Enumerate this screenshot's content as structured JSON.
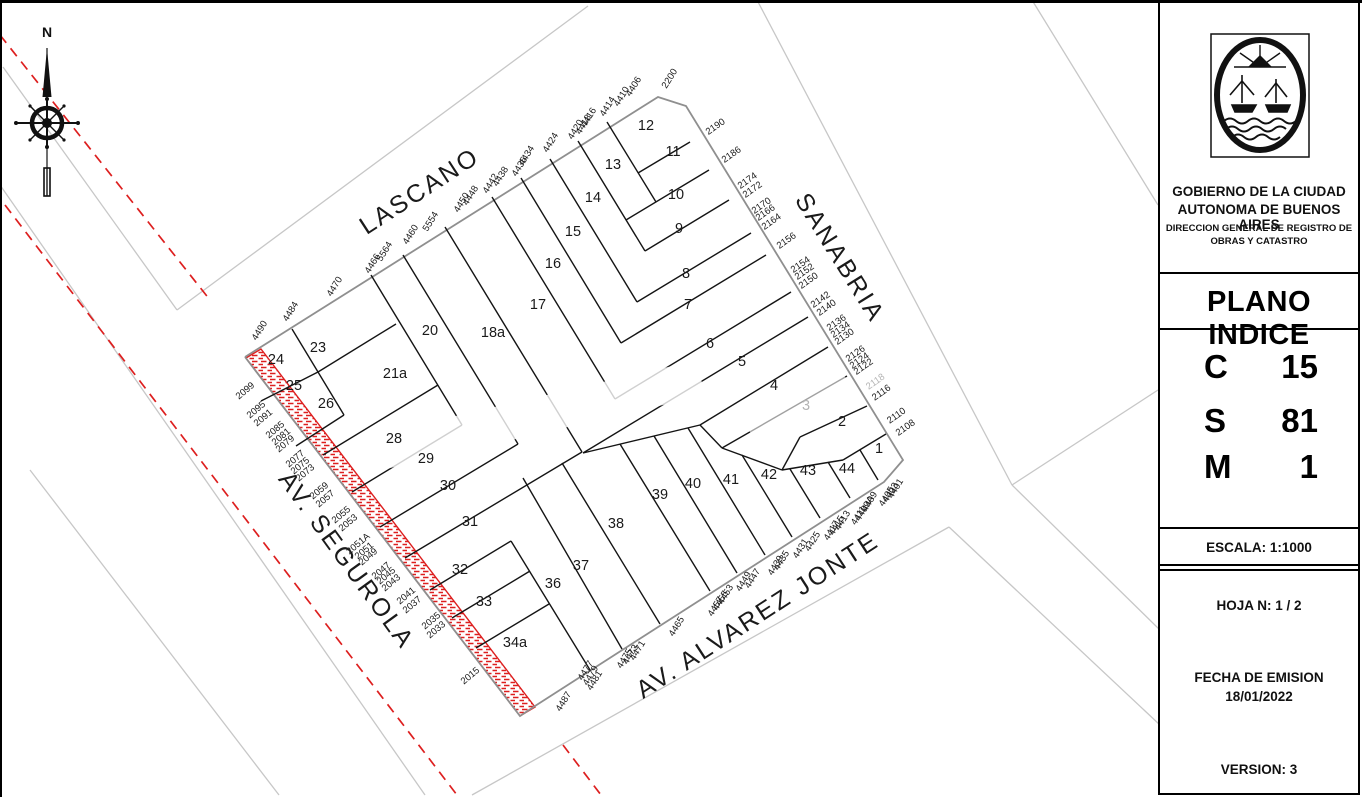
{
  "panel": {
    "org_line1": "GOBIERNO DE LA CIUDAD",
    "org_line2": "AUTONOMA DE BUENOS AIRES",
    "org_line3": "DIRECCION GENERAL DE REGISTRO DE",
    "org_line4": "OBRAS Y CATASTRO",
    "doc_title": "PLANO INDICE",
    "codes": [
      {
        "key": "C",
        "value": "15"
      },
      {
        "key": "S",
        "value": "81"
      },
      {
        "key": "M",
        "value": "1"
      }
    ],
    "escala": "ESCALA:   1:1000",
    "hoja": "HOJA N:   1 / 2",
    "fecha_label": "FECHA DE EMISION",
    "fecha_value": "18/01/2022",
    "version": "VERSION: 3"
  },
  "map": {
    "compass_label": "N",
    "colors": {
      "lot_line": "#141414",
      "outline": "#8f8f8f",
      "context": "#c7c7c7",
      "red": "#dd1f1f",
      "label": "#1a1a1a",
      "faded": "#b4b4b4"
    },
    "streets": [
      {
        "name": "LASCANO",
        "x": 424,
        "y": 198,
        "rot": -33
      },
      {
        "name": "SANABRIA",
        "x": 833,
        "y": 262,
        "rot": 58
      },
      {
        "name": "AV. SEGUROLA",
        "x": 340,
        "y": 565,
        "rot": 54
      },
      {
        "name": "AV. ALVAREZ JONTE",
        "x": 762,
        "y": 622,
        "rot": -33
      }
    ],
    "parcels": [
      {
        "n": "1",
        "x": 879,
        "y": 453
      },
      {
        "n": "2",
        "x": 842,
        "y": 426
      },
      {
        "n": "3",
        "x": 806,
        "y": 410,
        "faded": true
      },
      {
        "n": "4",
        "x": 774,
        "y": 390
      },
      {
        "n": "5",
        "x": 742,
        "y": 366
      },
      {
        "n": "6",
        "x": 710,
        "y": 348
      },
      {
        "n": "7",
        "x": 688,
        "y": 309
      },
      {
        "n": "8",
        "x": 686,
        "y": 278
      },
      {
        "n": "9",
        "x": 679,
        "y": 233
      },
      {
        "n": "10",
        "x": 676,
        "y": 199
      },
      {
        "n": "11",
        "x": 673,
        "y": 156
      },
      {
        "n": "12",
        "x": 646,
        "y": 130
      },
      {
        "n": "13",
        "x": 613,
        "y": 169
      },
      {
        "n": "14",
        "x": 593,
        "y": 202
      },
      {
        "n": "15",
        "x": 573,
        "y": 236
      },
      {
        "n": "16",
        "x": 553,
        "y": 268
      },
      {
        "n": "17",
        "x": 538,
        "y": 309
      },
      {
        "n": "18a",
        "x": 493,
        "y": 337
      },
      {
        "n": "20",
        "x": 430,
        "y": 335
      },
      {
        "n": "21a",
        "x": 395,
        "y": 378
      },
      {
        "n": "23",
        "x": 318,
        "y": 352
      },
      {
        "n": "24",
        "x": 276,
        "y": 364
      },
      {
        "n": "25",
        "x": 294,
        "y": 390
      },
      {
        "n": "26",
        "x": 326,
        "y": 408
      },
      {
        "n": "28",
        "x": 394,
        "y": 443
      },
      {
        "n": "29",
        "x": 426,
        "y": 463
      },
      {
        "n": "30",
        "x": 448,
        "y": 490
      },
      {
        "n": "31",
        "x": 470,
        "y": 526
      },
      {
        "n": "32",
        "x": 460,
        "y": 574
      },
      {
        "n": "33",
        "x": 484,
        "y": 606
      },
      {
        "n": "34a",
        "x": 515,
        "y": 647
      },
      {
        "n": "36",
        "x": 553,
        "y": 588
      },
      {
        "n": "37",
        "x": 581,
        "y": 570
      },
      {
        "n": "38",
        "x": 616,
        "y": 528
      },
      {
        "n": "39",
        "x": 660,
        "y": 499
      },
      {
        "n": "40",
        "x": 693,
        "y": 488
      },
      {
        "n": "41",
        "x": 731,
        "y": 484
      },
      {
        "n": "42",
        "x": 769,
        "y": 479
      },
      {
        "n": "43",
        "x": 808,
        "y": 475
      },
      {
        "n": "44",
        "x": 847,
        "y": 473
      }
    ],
    "addresses": {
      "lascano": {
        "rot": -58,
        "items": [
          {
            "t": "4490",
            "x": 262,
            "y": 332
          },
          {
            "t": "4484",
            "x": 293,
            "y": 313
          },
          {
            "t": "4470",
            "x": 337,
            "y": 288
          },
          {
            "t": "4466",
            "x": 375,
            "y": 265
          },
          {
            "t": "5564",
            "x": 387,
            "y": 253
          },
          {
            "t": "4460",
            "x": 413,
            "y": 236
          },
          {
            "t": "5554",
            "x": 433,
            "y": 223
          },
          {
            "t": "4450",
            "x": 464,
            "y": 204
          },
          {
            "t": "4448",
            "x": 473,
            "y": 197
          },
          {
            "t": "4442",
            "x": 493,
            "y": 185
          },
          {
            "t": "4438",
            "x": 503,
            "y": 178
          },
          {
            "t": "4436",
            "x": 522,
            "y": 168
          },
          {
            "t": "4434",
            "x": 529,
            "y": 157
          },
          {
            "t": "4424",
            "x": 553,
            "y": 144
          },
          {
            "t": "4420",
            "x": 578,
            "y": 131
          },
          {
            "t": "4418",
            "x": 586,
            "y": 126
          },
          {
            "t": "4416",
            "x": 591,
            "y": 119
          },
          {
            "t": "4414",
            "x": 610,
            "y": 108
          },
          {
            "t": "4410",
            "x": 624,
            "y": 98
          },
          {
            "t": "4406",
            "x": 636,
            "y": 88
          },
          {
            "t": "2200",
            "x": 672,
            "y": 80
          }
        ]
      },
      "sanabria": {
        "rot": -35,
        "items": [
          {
            "t": "2190",
            "x": 717,
            "y": 129
          },
          {
            "t": "2186",
            "x": 733,
            "y": 157
          },
          {
            "t": "2174",
            "x": 749,
            "y": 183
          },
          {
            "t": "2172",
            "x": 754,
            "y": 192
          },
          {
            "t": "2170",
            "x": 763,
            "y": 208
          },
          {
            "t": "2166",
            "x": 767,
            "y": 215
          },
          {
            "t": "2164",
            "x": 773,
            "y": 224
          },
          {
            "t": "2156",
            "x": 788,
            "y": 243
          },
          {
            "t": "2154",
            "x": 802,
            "y": 267
          },
          {
            "t": "2152",
            "x": 806,
            "y": 274
          },
          {
            "t": "2150",
            "x": 810,
            "y": 283
          },
          {
            "t": "2142",
            "x": 822,
            "y": 302
          },
          {
            "t": "2140",
            "x": 828,
            "y": 310
          },
          {
            "t": "2136",
            "x": 838,
            "y": 325
          },
          {
            "t": "2134",
            "x": 842,
            "y": 332
          },
          {
            "t": "2130",
            "x": 846,
            "y": 339
          },
          {
            "t": "2126",
            "x": 857,
            "y": 356
          },
          {
            "t": "2124",
            "x": 861,
            "y": 363
          },
          {
            "t": "2122",
            "x": 865,
            "y": 369
          },
          {
            "t": "2118",
            "x": 877,
            "y": 384,
            "faded": true
          },
          {
            "t": "2116",
            "x": 883,
            "y": 395
          },
          {
            "t": "2110",
            "x": 898,
            "y": 418
          },
          {
            "t": "2108",
            "x": 907,
            "y": 430
          }
        ]
      },
      "segurola": {
        "rot": -40,
        "items": [
          {
            "t": "2099",
            "x": 247,
            "y": 393
          },
          {
            "t": "2095",
            "x": 258,
            "y": 412
          },
          {
            "t": "2091",
            "x": 265,
            "y": 420
          },
          {
            "t": "2085",
            "x": 277,
            "y": 432
          },
          {
            "t": "2081",
            "x": 283,
            "y": 439
          },
          {
            "t": "2079",
            "x": 287,
            "y": 446
          },
          {
            "t": "2077",
            "x": 297,
            "y": 461
          },
          {
            "t": "2075",
            "x": 302,
            "y": 468
          },
          {
            "t": "2073",
            "x": 307,
            "y": 475
          },
          {
            "t": "2059",
            "x": 321,
            "y": 493
          },
          {
            "t": "2057",
            "x": 327,
            "y": 501
          },
          {
            "t": "2055",
            "x": 343,
            "y": 517
          },
          {
            "t": "2053",
            "x": 350,
            "y": 525
          },
          {
            "t": "2051A",
            "x": 360,
            "y": 546
          },
          {
            "t": "2051",
            "x": 366,
            "y": 553
          },
          {
            "t": "2049",
            "x": 370,
            "y": 559
          },
          {
            "t": "2047",
            "x": 383,
            "y": 573
          },
          {
            "t": "2045",
            "x": 388,
            "y": 578
          },
          {
            "t": "2043",
            "x": 393,
            "y": 585
          },
          {
            "t": "2041",
            "x": 408,
            "y": 598
          },
          {
            "t": "2037",
            "x": 414,
            "y": 607
          },
          {
            "t": "2035",
            "x": 433,
            "y": 623
          },
          {
            "t": "2033",
            "x": 438,
            "y": 632
          },
          {
            "t": "2015",
            "x": 472,
            "y": 678
          }
        ]
      },
      "jonte": {
        "rot": -58,
        "items": [
          {
            "t": "4487",
            "x": 566,
            "y": 703
          },
          {
            "t": "4481",
            "x": 597,
            "y": 682
          },
          {
            "t": "4479",
            "x": 593,
            "y": 677
          },
          {
            "t": "4477",
            "x": 588,
            "y": 672
          },
          {
            "t": "4475",
            "x": 627,
            "y": 660
          },
          {
            "t": "4473",
            "x": 633,
            "y": 656
          },
          {
            "t": "4471",
            "x": 640,
            "y": 652
          },
          {
            "t": "4465",
            "x": 679,
            "y": 628
          },
          {
            "t": "4457",
            "x": 718,
            "y": 608
          },
          {
            "t": "4455",
            "x": 723,
            "y": 602
          },
          {
            "t": "4453",
            "x": 728,
            "y": 596
          },
          {
            "t": "4449",
            "x": 746,
            "y": 583
          },
          {
            "t": "4447",
            "x": 755,
            "y": 580
          },
          {
            "t": "4439",
            "x": 778,
            "y": 567
          },
          {
            "t": "4435",
            "x": 784,
            "y": 562
          },
          {
            "t": "4431",
            "x": 803,
            "y": 550
          },
          {
            "t": "4425",
            "x": 815,
            "y": 543
          },
          {
            "t": "4417",
            "x": 834,
            "y": 532
          },
          {
            "t": "4415",
            "x": 839,
            "y": 527
          },
          {
            "t": "4413",
            "x": 845,
            "y": 522
          },
          {
            "t": "4411",
            "x": 861,
            "y": 517
          },
          {
            "t": "4409A",
            "x": 867,
            "y": 510
          },
          {
            "t": "4409",
            "x": 872,
            "y": 503
          },
          {
            "t": "4405",
            "x": 889,
            "y": 498
          },
          {
            "t": "4403",
            "x": 893,
            "y": 494
          },
          {
            "t": "4401",
            "x": 898,
            "y": 490
          }
        ]
      }
    },
    "outline": [
      [
        245,
        357
      ],
      [
        658,
        97
      ],
      [
        686,
        106
      ],
      [
        903,
        460
      ],
      [
        884,
        482
      ],
      [
        535,
        706
      ],
      [
        520,
        716
      ],
      [
        245,
        357
      ]
    ],
    "hatch_strip": [
      [
        246,
        358
      ],
      [
        520,
        716
      ],
      [
        535,
        707
      ],
      [
        261,
        349
      ]
    ],
    "lot_lines": [
      [
        292,
        329,
        318,
        372
      ],
      [
        261,
        401,
        318,
        372
      ],
      [
        318,
        372,
        396,
        324
      ],
      [
        296,
        446,
        344,
        415
      ],
      [
        318,
        372,
        344,
        415
      ],
      [
        371,
        275,
        462,
        425
      ],
      [
        403,
        255,
        518,
        444
      ],
      [
        445,
        227,
        582,
        452
      ],
      [
        492,
        197,
        615,
        399
      ],
      [
        521,
        178,
        621,
        343
      ],
      [
        550,
        159,
        637,
        302
      ],
      [
        578,
        141,
        645,
        251
      ],
      [
        607,
        122,
        656,
        202
      ],
      [
        690,
        142,
        638,
        173
      ],
      [
        709,
        170,
        626,
        220
      ],
      [
        729,
        200,
        645,
        251
      ],
      [
        751,
        233,
        637,
        302
      ],
      [
        766,
        255,
        621,
        343
      ],
      [
        791,
        292,
        615,
        399
      ],
      [
        808,
        317,
        583,
        453
      ],
      [
        828,
        347,
        700,
        425
      ],
      [
        847,
        376,
        722,
        448
      ],
      [
        867,
        406,
        800,
        437
      ],
      [
        886,
        434,
        843,
        460
      ],
      [
        583,
        453,
        700,
        425
      ],
      [
        700,
        425,
        722,
        448
      ],
      [
        722,
        448,
        782,
        470
      ],
      [
        782,
        470,
        843,
        460
      ],
      [
        800,
        437,
        782,
        470
      ],
      [
        323,
        455,
        438,
        385
      ],
      [
        352,
        492,
        462,
        425
      ],
      [
        380,
        527,
        518,
        444
      ],
      [
        405,
        558,
        582,
        452
      ],
      [
        430,
        590,
        511,
        541
      ],
      [
        452,
        618,
        530,
        571
      ],
      [
        476,
        648,
        549,
        604
      ],
      [
        590,
        670,
        511,
        541
      ],
      [
        622,
        649,
        523,
        478
      ],
      [
        660,
        624,
        562,
        463
      ],
      [
        710,
        591,
        620,
        444
      ],
      [
        737,
        573,
        654,
        436
      ],
      [
        765,
        555,
        688,
        428
      ],
      [
        792,
        537,
        742,
        455
      ],
      [
        820,
        518,
        790,
        469
      ],
      [
        850,
        498,
        828,
        462
      ],
      [
        878,
        480,
        860,
        450
      ]
    ],
    "context_lines": [
      [
        3,
        67,
        177,
        310
      ],
      [
        177,
        310,
        588,
        6
      ],
      [
        0,
        185,
        425,
        795
      ],
      [
        30,
        470,
        279,
        795
      ],
      [
        472,
        795,
        949,
        527
      ],
      [
        949,
        527,
        1160,
        725
      ],
      [
        1012,
        485,
        1158,
        390
      ],
      [
        1012,
        485,
        1160,
        630
      ],
      [
        757,
        0,
        1012,
        485
      ],
      [
        1032,
        0,
        1158,
        205
      ]
    ],
    "red_dashed": [
      [
        0,
        35,
        210,
        300
      ],
      [
        5,
        205,
        457,
        795
      ],
      [
        563,
        745,
        601,
        795
      ]
    ],
    "watermarks": [
      {
        "x": 540,
        "y": 415,
        "w": 330,
        "h": 36,
        "rot": -13,
        "o": 0.8
      },
      {
        "x": 795,
        "y": 400,
        "w": 110,
        "h": 42,
        "rot": -30,
        "o": 0.6
      }
    ]
  }
}
